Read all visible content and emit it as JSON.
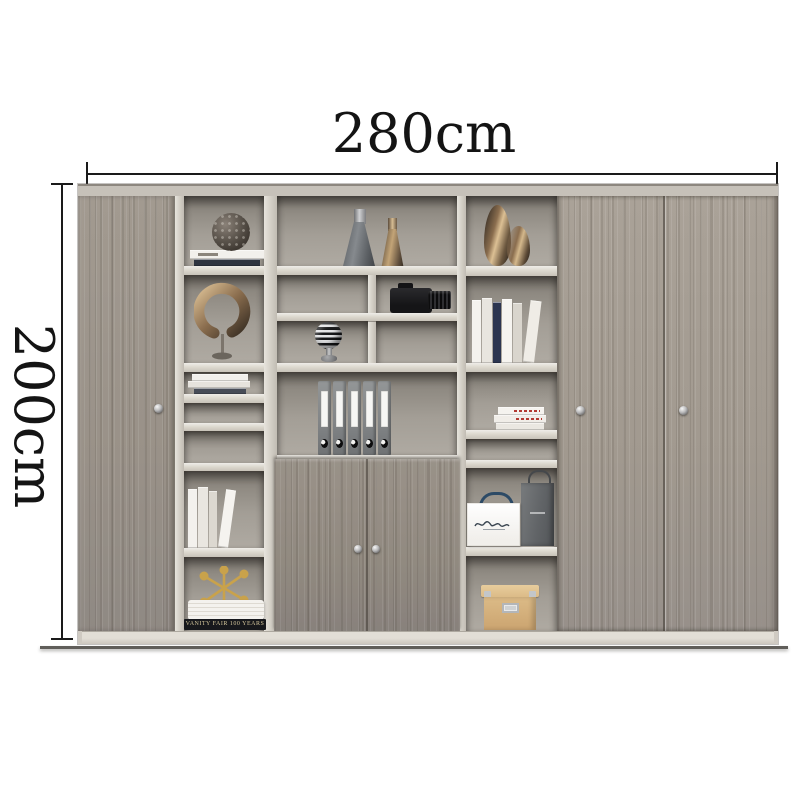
{
  "annotations": {
    "width_label": "280cm",
    "height_label": "200cm"
  },
  "decor_text": {
    "book_spine_bottom_left": "VANITY FAIR 100 YEARS"
  },
  "scene": {
    "subject": "grey wood office wall cabinet with open shelving",
    "objects": [
      "left-sliding-wood-door",
      "right-sliding-wood-doors",
      "center-two-door-cabinet",
      "lattice-sphere-ornament",
      "grey-cone-vase",
      "bronze-cone-vase",
      "bronze-teardrop-vases",
      "bronze-ring-sculpture",
      "dslr-camera",
      "striped-sphere-finial",
      "ring-binders",
      "standing-books",
      "stacked-books",
      "white-shopping-bag",
      "grey-shopping-bag",
      "tan-storage-box",
      "gold-jack-ornament"
    ]
  },
  "colors": {
    "background": "#ffffff",
    "wood": "#a49c92",
    "frame": "#dcd8d0",
    "cell_shadow": "#6f6a63",
    "dimension_lines": "#1a1a1a",
    "binder_grey": "#85888a",
    "box_tan": "#d9b886",
    "bag_handle_navy": "#2c4a66",
    "camera_black": "#1c1c1e"
  }
}
